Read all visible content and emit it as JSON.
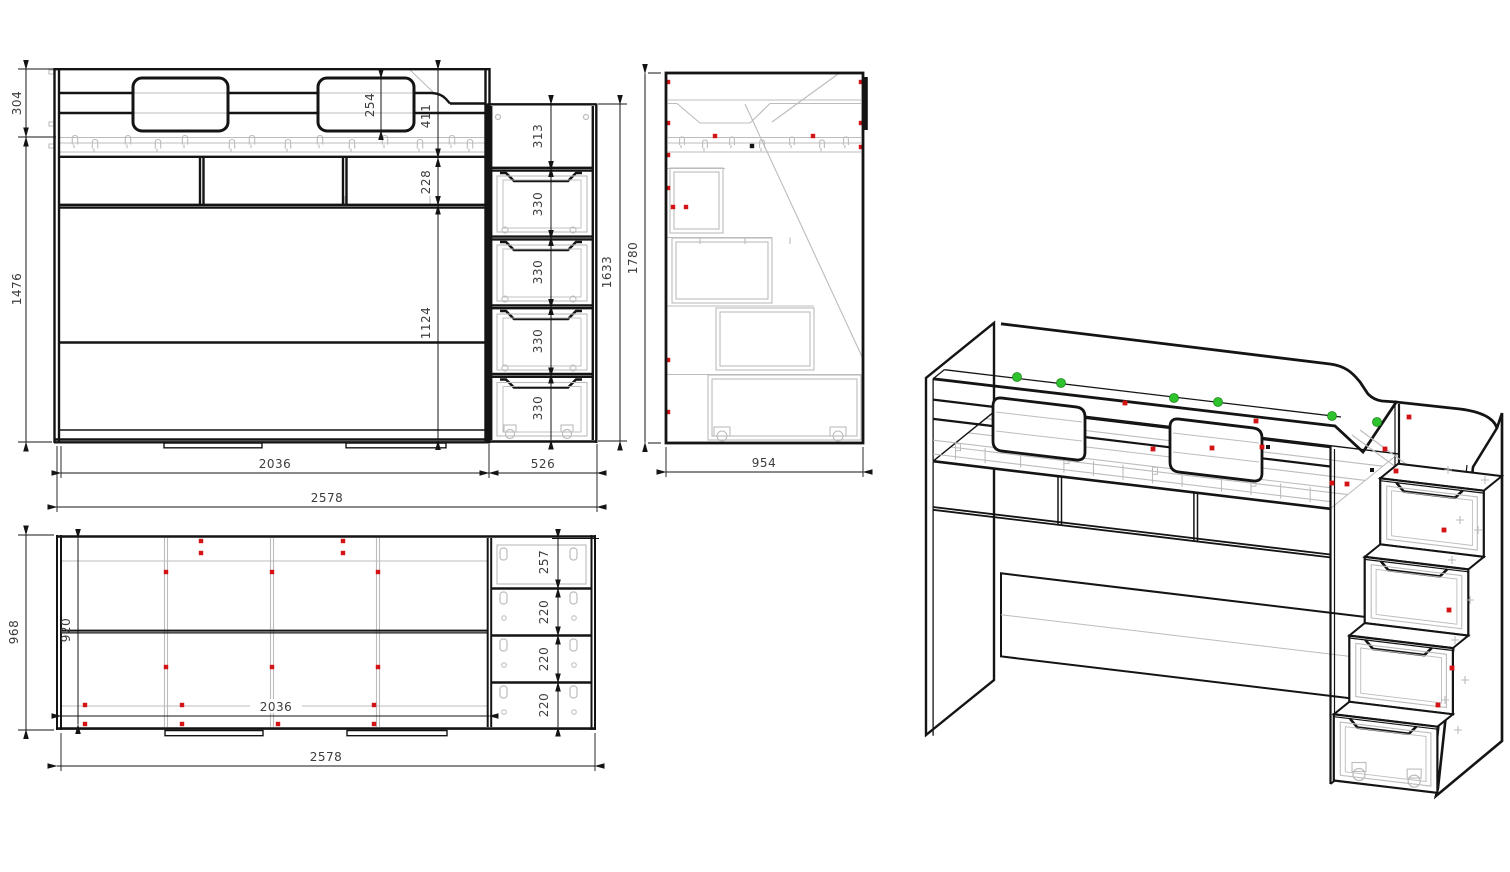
{
  "document": {
    "type": "furniture technical drawing",
    "subject": "loft bed with staircase drawers"
  },
  "colors": {
    "line": "#141414",
    "hidden_line": "#bcbcbc",
    "dim_text": "#3c3c3c",
    "marker_red": "#d41414",
    "marker_green": "#2ec22e",
    "background": "#ffffff"
  },
  "views": {
    "front_elevation": {
      "dims": {
        "top_rail_height": "304",
        "body_height": "1476",
        "cutout_height": "254",
        "rail_to_platform": "411",
        "shelf_band_height": "228",
        "lower_panel_height": "1124",
        "stair_top_opening": "313",
        "stair_drawer_heights": [
          "330",
          "330",
          "330",
          "330"
        ],
        "stair_column_height": "1633",
        "bed_width": "2036",
        "stair_width": "526",
        "total_width": "2578"
      }
    },
    "side_elevation": {
      "dims": {
        "total_height": "1780",
        "total_depth": "954"
      }
    },
    "plan_view": {
      "dims": {
        "total_depth": "968",
        "inner_depth": "920",
        "bed_inner_width": "2036",
        "total_width": "2578",
        "stair_compartments": [
          "257",
          "220",
          "220",
          "220"
        ]
      }
    },
    "isometric": {
      "markers": {
        "green": "assembly point",
        "red": "fastener",
        "black": "fastener"
      }
    }
  }
}
